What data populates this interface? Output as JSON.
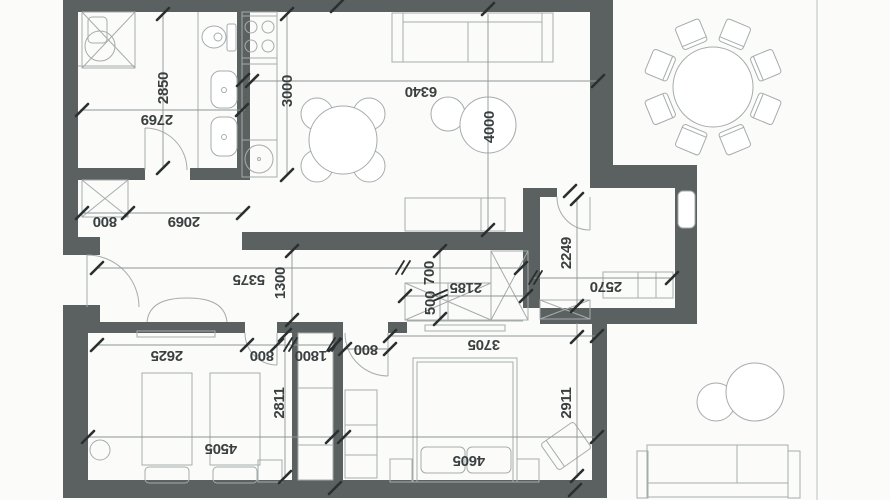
{
  "drawing": {
    "type": "apartment floor plan",
    "units": "mm"
  },
  "colors": {
    "background": "#fbfbfa",
    "wall": "#5b6060",
    "furniture_line": "#a6acac",
    "dim_line": "#8f9595",
    "tick": "#2a2f2f",
    "text": "#3a3f3f"
  },
  "dimension_labels": [
    {
      "id": "bath-height",
      "text": "2850",
      "x": 163,
      "y": 88,
      "rot": -90
    },
    {
      "id": "bath-width",
      "text": "2769",
      "x": 157,
      "y": 120,
      "rot": 180
    },
    {
      "id": "kitchen-depth",
      "text": "3000",
      "x": 287,
      "y": 91,
      "rot": -90
    },
    {
      "id": "living-width",
      "text": "6340",
      "x": 421,
      "y": 92,
      "rot": 180
    },
    {
      "id": "living-depth",
      "text": "4000",
      "x": 489,
      "y": 127,
      "rot": -90
    },
    {
      "id": "hall-wardrobe",
      "text": "800",
      "x": 105,
      "y": 222,
      "rot": 180
    },
    {
      "id": "hall-opening",
      "text": "2069",
      "x": 184,
      "y": 222,
      "rot": 180
    },
    {
      "id": "corridor-length",
      "text": "5375",
      "x": 249,
      "y": 280,
      "rot": 180
    },
    {
      "id": "corridor-width",
      "text": "1300",
      "x": 280,
      "y": 283,
      "rot": -90
    },
    {
      "id": "wardrobe-depth-1",
      "text": "700",
      "x": 429,
      "y": 273,
      "rot": -90
    },
    {
      "id": "wardrobe-depth-2",
      "text": "500",
      "x": 430,
      "y": 303,
      "rot": -90
    },
    {
      "id": "wardrobe-width",
      "text": "2185",
      "x": 466,
      "y": 288,
      "rot": 180
    },
    {
      "id": "office-depth",
      "text": "2249",
      "x": 566,
      "y": 253,
      "rot": -90
    },
    {
      "id": "office-width",
      "text": "2570",
      "x": 606,
      "y": 287,
      "rot": 180
    },
    {
      "id": "kids-wall",
      "text": "2625",
      "x": 167,
      "y": 356,
      "rot": 180
    },
    {
      "id": "kids-door",
      "text": "800",
      "x": 262,
      "y": 356,
      "rot": 180
    },
    {
      "id": "closet-width",
      "text": "1800",
      "x": 311,
      "y": 356,
      "rot": 180
    },
    {
      "id": "master-door",
      "text": "800",
      "x": 366,
      "y": 350,
      "rot": 180
    },
    {
      "id": "master-width",
      "text": "3705",
      "x": 484,
      "y": 345,
      "rot": 180
    },
    {
      "id": "kids-depth",
      "text": "2811",
      "x": 279,
      "y": 403,
      "rot": -90
    },
    {
      "id": "master-depth",
      "text": "2911",
      "x": 566,
      "y": 403,
      "rot": -90
    },
    {
      "id": "kids-total-width",
      "text": "4505",
      "x": 221,
      "y": 449,
      "rot": 180
    },
    {
      "id": "master-total-width",
      "text": "4605",
      "x": 469,
      "y": 461,
      "rot": 180
    }
  ]
}
